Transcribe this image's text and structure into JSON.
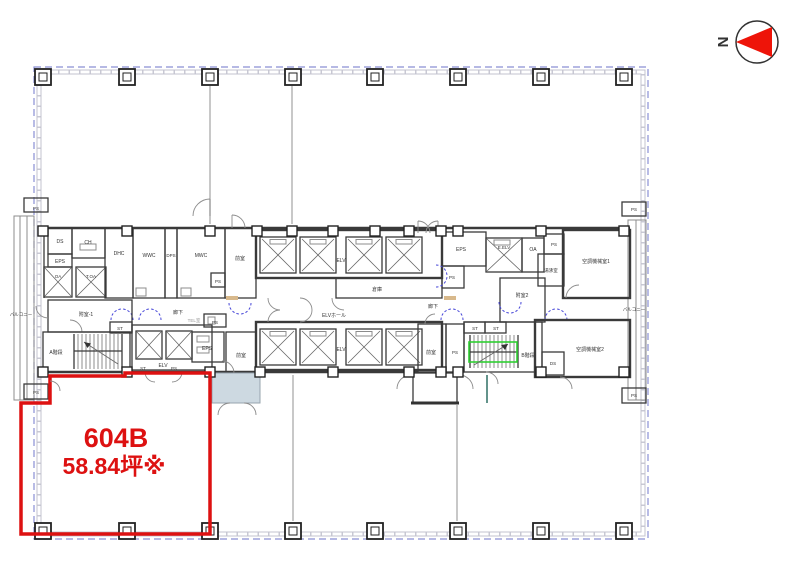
{
  "compass": {
    "north": "N"
  },
  "unit": {
    "name": "604B",
    "area": "58.84坪※"
  },
  "rooms": {
    "ps": "PS",
    "eps": "EPS",
    "ds": "DS",
    "ch": "CH",
    "dhc": "DHC",
    "wwc": "WWC",
    "dps": "DPS",
    "mwc": "MWC",
    "oa": "OA",
    "t_oa": "T.OA",
    "st": "ST",
    "elv": "ELV",
    "e_elv": "E.ELV",
    "elv_hall": "ELVホール",
    "souko": "倉庫",
    "rouka": "廊下",
    "zenshitsu": "前室",
    "fushitsu1": "附室-1",
    "fushitsu2": "附室2",
    "a_stair": "A階段",
    "b_stair": "B階段",
    "kucho1": "空調機械室1",
    "kucho2": "空調機械室2",
    "yuwakashi": "湯沸室",
    "tel": "TEL室",
    "balcony": "バルコニー"
  },
  "colors": {
    "unit_outline": "#dd1111",
    "boundary_dash": "#8a8fd4",
    "stair_highlight": "#2fd032",
    "vestibule_fill": "#cdd9e1",
    "compass_red": "#ee1409"
  }
}
